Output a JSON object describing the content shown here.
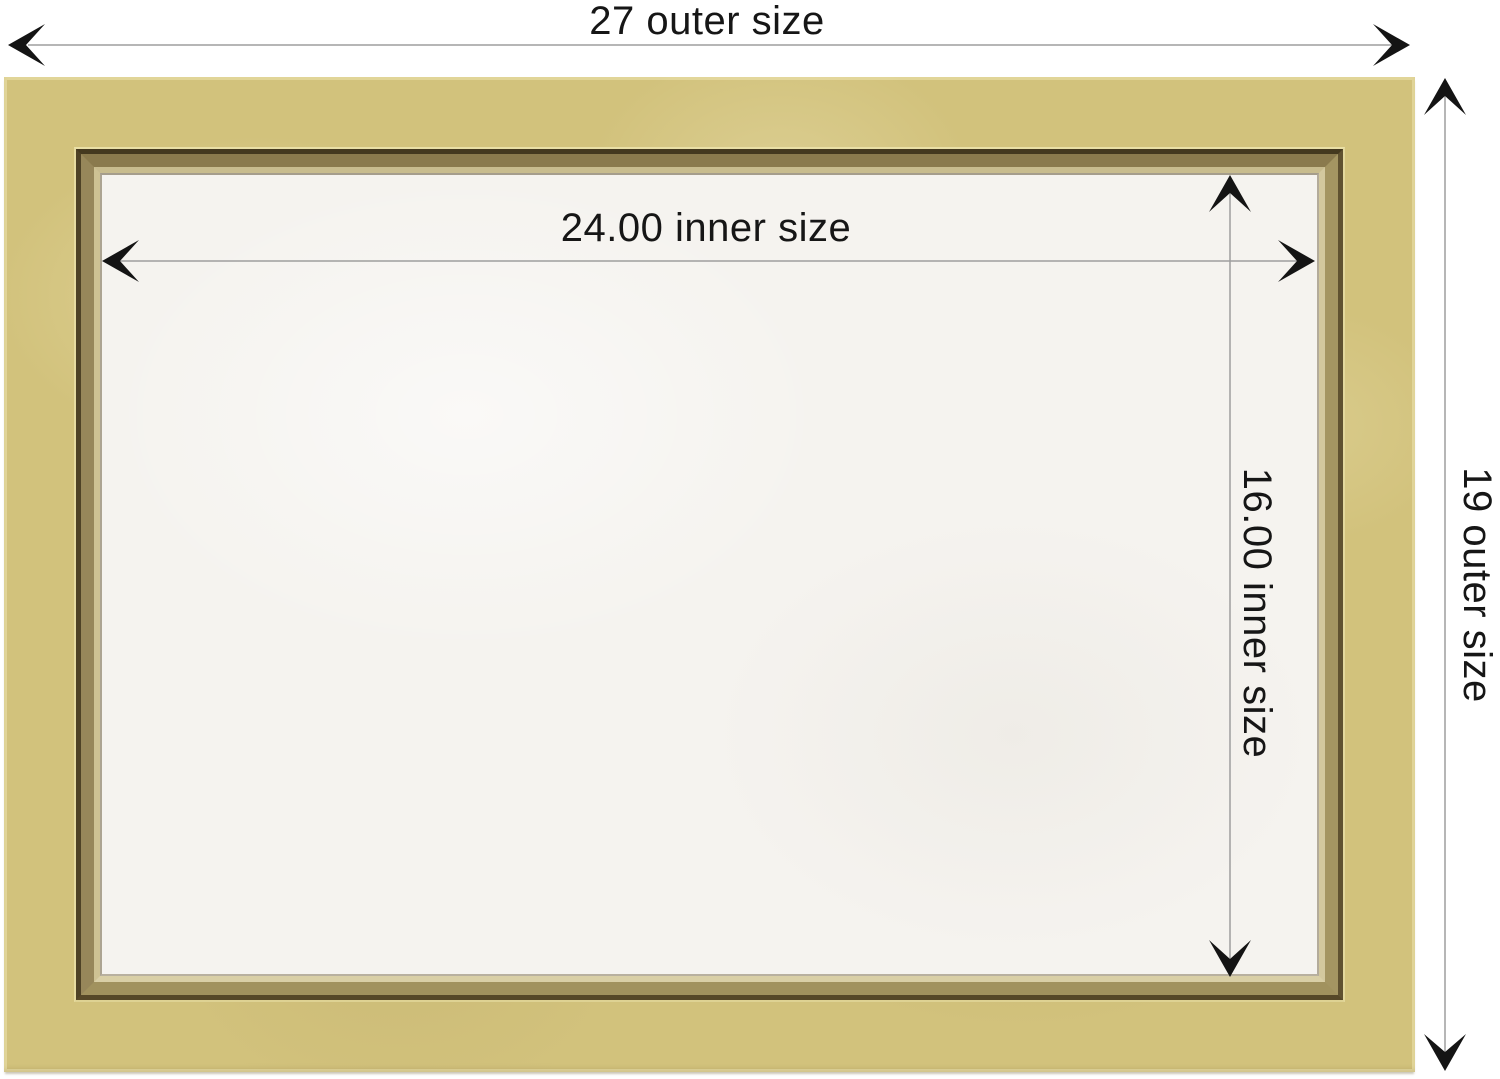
{
  "labels": {
    "outer_width": "27 outer size",
    "outer_height": "19 outer size",
    "inner_width": "24.00 inner size",
    "inner_height": "16.00 inner size"
  },
  "measurements": {
    "outer_width": 27,
    "outer_height": 19,
    "inner_width": 24.0,
    "inner_height": 16.0
  },
  "colors": {
    "background": "#ffffff",
    "frame_gold": "#d2c27c",
    "bevel_dark_ridge": "#44391f",
    "bevel_cream_lip": "#d3c89e",
    "inner_surface": "#f5f3ef",
    "dimension_line": "#9e9e9e",
    "arrow_and_text": "#141414"
  }
}
